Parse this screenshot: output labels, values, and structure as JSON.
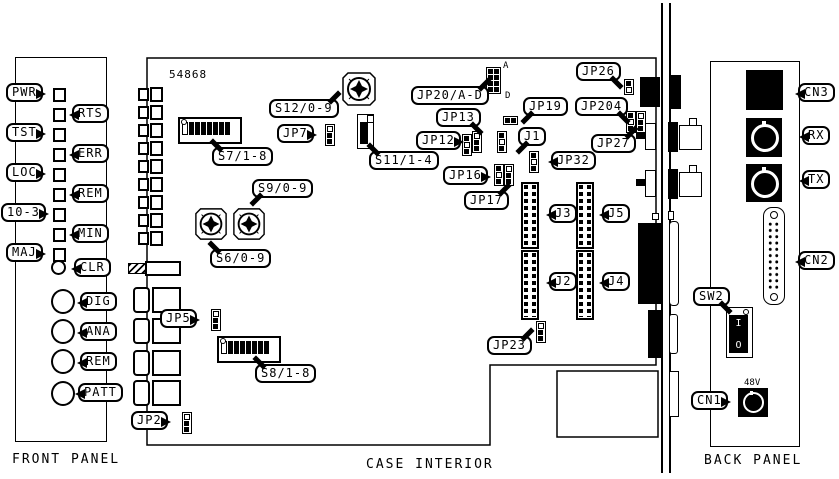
{
  "sections": {
    "front": "FRONT PANEL",
    "case": "CASE INTERIOR",
    "back": "BACK PANEL"
  },
  "front_panel": {
    "leds": [
      "PWR",
      "RTS",
      "TST",
      "ERR",
      "LOC",
      "REM",
      "10-3",
      "MIN",
      "MAJ"
    ],
    "clear_button": "CLR",
    "jacks": [
      "DIG",
      "ANA",
      "REM",
      "PATT"
    ]
  },
  "case_interior": {
    "board_number": "54868",
    "components": {
      "s12": "S12/0-9",
      "jp7": "JP7",
      "s7": "S7/1-8",
      "s11": "S11/1-4",
      "s9": "S9/0-9",
      "s6": "S6/0-9",
      "jp20": "JP20/A-D",
      "jp13": "JP13",
      "jp12": "JP12",
      "jp19": "JP19",
      "jp26": "JP26",
      "jp204": "JP204",
      "jp27": "JP27",
      "j1": "J1",
      "jp32": "JP32",
      "jp16": "JP16",
      "jp17": "JP17",
      "j3": "J3",
      "j5": "J5",
      "j2": "J2",
      "j4": "J4",
      "jp23": "JP23",
      "jp5": "JP5",
      "s8": "S8/1-8",
      "jp2": "JP2"
    },
    "jp20_pins": {
      "a": "A",
      "d": "D"
    }
  },
  "back_panel": {
    "cn3": "CN3",
    "rx": "RX",
    "tx": "TX",
    "cn2": "CN2",
    "sw2": "SW2",
    "cn1": "CN1",
    "voltage": "48V",
    "switch_on": "I",
    "switch_off": "O"
  },
  "colors": {
    "line": "#000000",
    "background": "#ffffff"
  }
}
